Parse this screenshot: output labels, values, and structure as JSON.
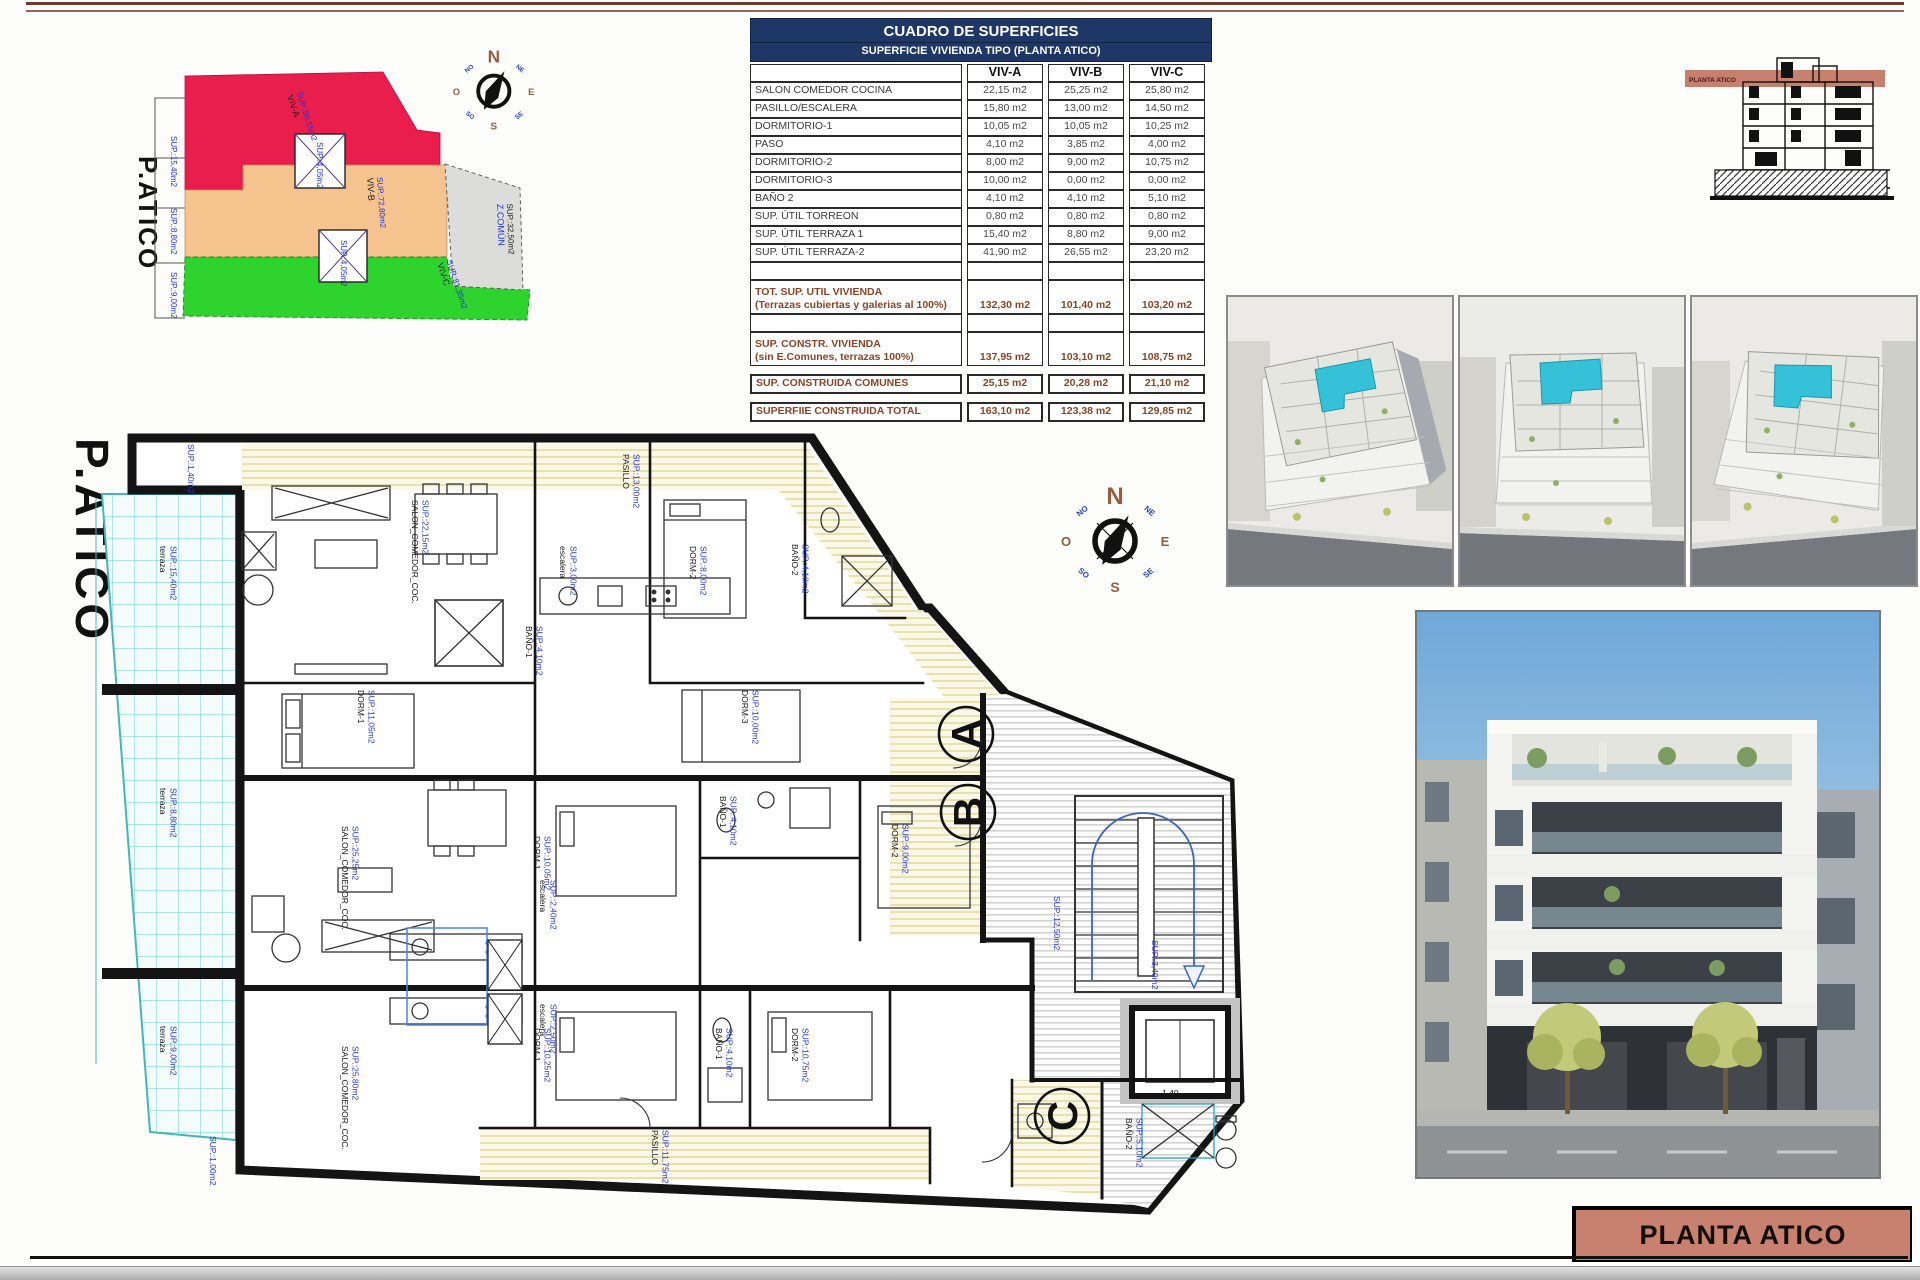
{
  "page": {
    "title_block": "PLANTA ATICO",
    "section_band_label": "PLANTA ATICO"
  },
  "table": {
    "title": "CUADRO DE SUPERFICIES",
    "subtitle": "SUPERFICIE VIVIENDA TIPO  (PLANTA ATICO)",
    "columns": [
      "VIV-A",
      "VIV-B",
      "VIV-C"
    ],
    "rows": [
      {
        "label": "SALON COMEDOR COCINA",
        "a": "22,15 m2",
        "b": "25,25 m2",
        "c": "25,80 m2"
      },
      {
        "label": "PASILLO/ESCALERA",
        "a": "15,80 m2",
        "b": "13,00 m2",
        "c": "14,50 m2"
      },
      {
        "label": "DORMITORIO-1",
        "a": "10,05 m2",
        "b": "10,05 m2",
        "c": "10,25 m2"
      },
      {
        "label": "PASO",
        "a": "4,10 m2",
        "b": "3,85 m2",
        "c": "4,00 m2"
      },
      {
        "label": "DORMITORIO-2",
        "a": "8,00 m2",
        "b": "9,00 m2",
        "c": "10,75 m2"
      },
      {
        "label": "DORMITORIO-3",
        "a": "10,00 m2",
        "b": "0,00 m2",
        "c": "0,00 m2"
      },
      {
        "label": "BAÑO 2",
        "a": "4,10 m2",
        "b": "4,10 m2",
        "c": "5,10 m2"
      },
      {
        "label": "SUP. ÚTIL TORREON",
        "a": "0,80 m2",
        "b": "0,80 m2",
        "c": "0,80 m2"
      },
      {
        "label": "SUP. ÚTIL TERRAZA 1",
        "a": "15,40 m2",
        "b": "8,80 m2",
        "c": "9,00 m2"
      },
      {
        "label": "SUP. ÚTIL TERRAZA-2",
        "a": "41,90 m2",
        "b": "26,55 m2",
        "c": "23,20 m2"
      }
    ],
    "totals": [
      {
        "label": "TOT. SUP. UTIL VIVIENDA",
        "label2": "(Terrazas cubiertas y galerias al 100%)",
        "a": "132,30 m2",
        "b": "101,40 m2",
        "c": "103,20 m2",
        "boxed": false
      },
      {
        "label": "SUP. CONSTR. VIVIENDA",
        "label2": "(sin E.Comunes, terrazas 100%)",
        "a": "137,95 m2",
        "b": "103,10 m2",
        "c": "108,75 m2",
        "boxed": false
      },
      {
        "label": "SUP. CONSTRUIDA COMUNES",
        "label2": "",
        "a": "25,15 m2",
        "b": "20,28 m2",
        "c": "21,10 m2",
        "boxed": true
      },
      {
        "label": "SUPERFIIE CONSTRUIDA TOTAL",
        "label2": "",
        "a": "163,10 m2",
        "b": "123,38 m2",
        "c": "129,85 m2",
        "boxed": true
      }
    ]
  },
  "compass": {
    "n": "N",
    "ne": "NE",
    "e": "E",
    "se": "SE",
    "s": "S",
    "so": "SO",
    "o": "O",
    "no": "NO"
  },
  "site_plan": {
    "title": "P.ATICO",
    "labels": [
      {
        "t1": "VIV-A",
        "t2": "SUP.:98,15m2",
        "x": 192,
        "y": 68,
        "r": 72
      },
      {
        "t1": "VIV-B",
        "t2": "SUP.:72,80m2",
        "x": 272,
        "y": 150,
        "r": 86
      },
      {
        "t1": "VIV-C",
        "t2": "SUP.:81,35m2",
        "x": 342,
        "y": 236,
        "r": 72
      },
      {
        "t1": "Z.COMÚN",
        "t2": "SUP.:32,50m2",
        "x": 402,
        "y": 176,
        "r": 88,
        "c1": "#2233dd",
        "c2": "#1a1a1a"
      },
      {
        "t1": "",
        "t2": "SUP.:15,40m2",
        "x": 76,
        "y": 108,
        "r": 90
      },
      {
        "t1": "",
        "t2": "SUP.:8,80m2",
        "x": 76,
        "y": 180,
        "r": 90
      },
      {
        "t1": "",
        "t2": "SUP.:9,00m2",
        "x": 76,
        "y": 244,
        "r": 90
      },
      {
        "t1": "",
        "t2": "SUP.:4,05m2",
        "x": 222,
        "y": 114,
        "r": 90
      },
      {
        "t1": "",
        "t2": "SUP.:4,05m2",
        "x": 246,
        "y": 212,
        "r": 90
      }
    ]
  },
  "plan": {
    "title": "P.ATICO",
    "markers": [
      "A",
      "B",
      "C"
    ],
    "labels": [
      {
        "t1": "terraza",
        "t2": "SUP.:15,40m2",
        "x": 70,
        "y": 118,
        "r": 90
      },
      {
        "t1": "SALON_COMEDOR_COC.",
        "t2": "SUP.:22,15m2",
        "x": 322,
        "y": 72,
        "r": 90
      },
      {
        "t1": "PASILLO",
        "t2": "SUP.:13,00m2",
        "x": 533,
        "y": 26,
        "r": 90
      },
      {
        "t1": "DORM-1",
        "t2": "SUP.:11,05m2",
        "x": 268,
        "y": 262,
        "r": 90
      },
      {
        "t1": "BAÑO-1",
        "t2": "SUP.:4,10m2",
        "x": 436,
        "y": 198,
        "r": 90
      },
      {
        "t1": "DORM-2",
        "t2": "SUP.:8,00m2",
        "x": 600,
        "y": 118,
        "r": 90
      },
      {
        "t1": "BAÑO-2",
        "t2": "SUP.:4,10m2",
        "x": 702,
        "y": 116,
        "r": 90
      },
      {
        "t1": "DORM-3",
        "t2": "SUP.:10,00m2",
        "x": 652,
        "y": 262,
        "r": 90
      },
      {
        "t1": "escalera",
        "t2": "SUP.:3,00m2",
        "x": 470,
        "y": 118,
        "r": 90
      },
      {
        "t1": "",
        "t2": "SUP.:1,40m2",
        "x": 98,
        "y": 16,
        "r": 90
      },
      {
        "t1": "terraza",
        "t2": "SUP.:8,80m2",
        "x": 70,
        "y": 360,
        "r": 90
      },
      {
        "t1": "SALON_COMEDOR_COC.",
        "t2": "SUP.:25,25m2",
        "x": 252,
        "y": 398,
        "r": 90
      },
      {
        "t1": "DORM-1",
        "t2": "SUP.:10,05m2",
        "x": 444,
        "y": 408,
        "r": 90
      },
      {
        "t1": "DORM-2",
        "t2": "SUP.:9,00m2",
        "x": 802,
        "y": 396,
        "r": 90
      },
      {
        "t1": "BAÑO-1",
        "t2": "SUP.:4,10m2",
        "x": 630,
        "y": 368,
        "r": 90
      },
      {
        "t1": "",
        "t2": "SUP.:12,50m2",
        "x": 964,
        "y": 468,
        "r": 90
      },
      {
        "t1": "",
        "t2": "SUP.:3,40m2",
        "x": 1062,
        "y": 512,
        "r": 90
      },
      {
        "t1": "terraza",
        "t2": "SUP.:9,00m2",
        "x": 70,
        "y": 598,
        "r": 90
      },
      {
        "t1": "SALON_COMEDOR_COC.",
        "t2": "SUP.:25,80m2",
        "x": 252,
        "y": 618,
        "r": 90
      },
      {
        "t1": "DORM-1",
        "t2": "SUP.:10,25m2",
        "x": 444,
        "y": 600,
        "r": 90
      },
      {
        "t1": "DORM-2",
        "t2": "SUP.:10,75m2",
        "x": 702,
        "y": 600,
        "r": 90
      },
      {
        "t1": "BAÑO-1",
        "t2": "SUP.:4,10m2",
        "x": 626,
        "y": 600,
        "r": 90
      },
      {
        "t1": "BAÑO-2",
        "t2": "SUP.:5,10m2",
        "x": 1036,
        "y": 690,
        "r": 90
      },
      {
        "t1": "PASILLO",
        "t2": "SUP.:11,75m2",
        "x": 562,
        "y": 702,
        "r": 90
      },
      {
        "t1": "escalera",
        "t2": "SUP.:2,40m2",
        "x": 450,
        "y": 452,
        "r": 90
      },
      {
        "t1": "escalera",
        "t2": "SUP.:2,50m2",
        "x": 450,
        "y": 576,
        "r": 90
      },
      {
        "t1": "1,40",
        "t2": "",
        "x": 1072,
        "y": 668,
        "r": 0
      },
      {
        "t1": "",
        "t2": "SUP.:1,00m2",
        "x": 120,
        "y": 708,
        "r": 90
      }
    ]
  }
}
